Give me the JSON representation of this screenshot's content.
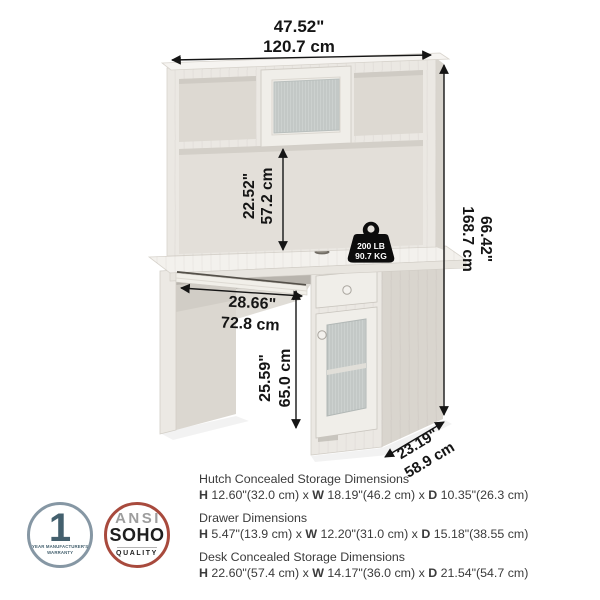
{
  "dimensions": {
    "overall_width": {
      "in": "47.52\"",
      "cm": "120.7 cm"
    },
    "hutch_opening_height": {
      "in": "22.52\"",
      "cm": "57.2 cm"
    },
    "overall_height": {
      "in": "66.42\"",
      "cm": "168.7 cm"
    },
    "keyboard_tray_width": {
      "in": "28.66\"",
      "cm": "72.8 cm"
    },
    "knee_space_height": {
      "in": "25.59\"",
      "cm": "65.0 cm"
    },
    "overall_depth": {
      "in": "23.19\"",
      "cm": "58.9 cm"
    }
  },
  "weight_capacity": {
    "lb": "200 LB",
    "kg": "90.7 KG"
  },
  "specs": {
    "sep": "x",
    "labels": {
      "h": "H",
      "w": "W",
      "d": "D"
    },
    "groups": [
      {
        "title": "Hutch Concealed Storage Dimensions",
        "h": "12.60\"(32.0 cm)",
        "w": "18.19\"(46.2 cm)",
        "d": "10.35\"(26.3 cm)"
      },
      {
        "title": "Drawer Dimensions",
        "h": "5.47\"(13.9 cm)",
        "w": "12.20\"(31.0 cm)",
        "d": "15.18\"(38.55 cm)"
      },
      {
        "title": "Desk Concealed Storage Dimensions",
        "h": "22.60\"(57.4 cm)",
        "w": "14.17\"(36.0 cm)",
        "d": "21.54\"(54.7 cm)"
      }
    ]
  },
  "badges": {
    "warranty": {
      "number": "1",
      "line1": "YEAR MANUFACTURER'S",
      "line2": "WARRANTY"
    },
    "quality": {
      "org": "ANSI",
      "name": "SOHO",
      "label": "QUALITY"
    }
  },
  "colors": {
    "dimension_text": "#151515",
    "spec_text": "#3b3b3b",
    "warranty_badge": "#44606e",
    "warranty_ring": "#8697a4",
    "quality_ring": "#a84a3d",
    "quality_org_text": "#9d9d9d",
    "furniture_finish": "#ebe8e3"
  }
}
